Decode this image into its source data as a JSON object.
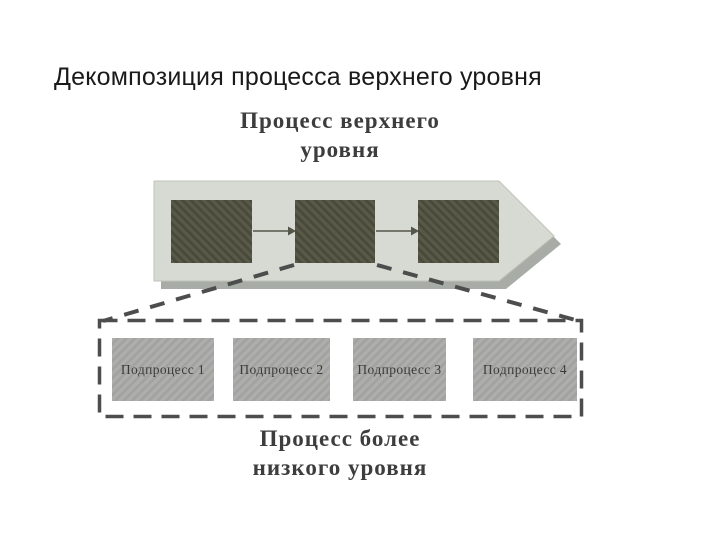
{
  "title": "Декомпозиция процесса верхнего уровня",
  "top_process": {
    "label": "Процесс верхнего уровня",
    "step_count": 3
  },
  "lower_process": {
    "label": "Процесс более низкого уровня"
  },
  "subprocesses": [
    {
      "label": "Подпроцесс 1"
    },
    {
      "label": "Подпроцесс 2"
    },
    {
      "label": "Подпроцесс 3"
    },
    {
      "label": "Подпроцесс 4"
    }
  ],
  "colors": {
    "background": "#ffffff",
    "title_text": "#1a1a1a",
    "heading_text": "#3d3d3d",
    "arrow_body": "#d6dad2",
    "arrow_edge": "#bfc4ba",
    "arrow_shadow": "#9fa39c",
    "step_box": "#50503f",
    "subprocess_box": "#a9aaa8",
    "subprocess_text": "#3a3a3a",
    "dashed_line": "#4d4d4d",
    "connector_line": "#55554a"
  }
}
